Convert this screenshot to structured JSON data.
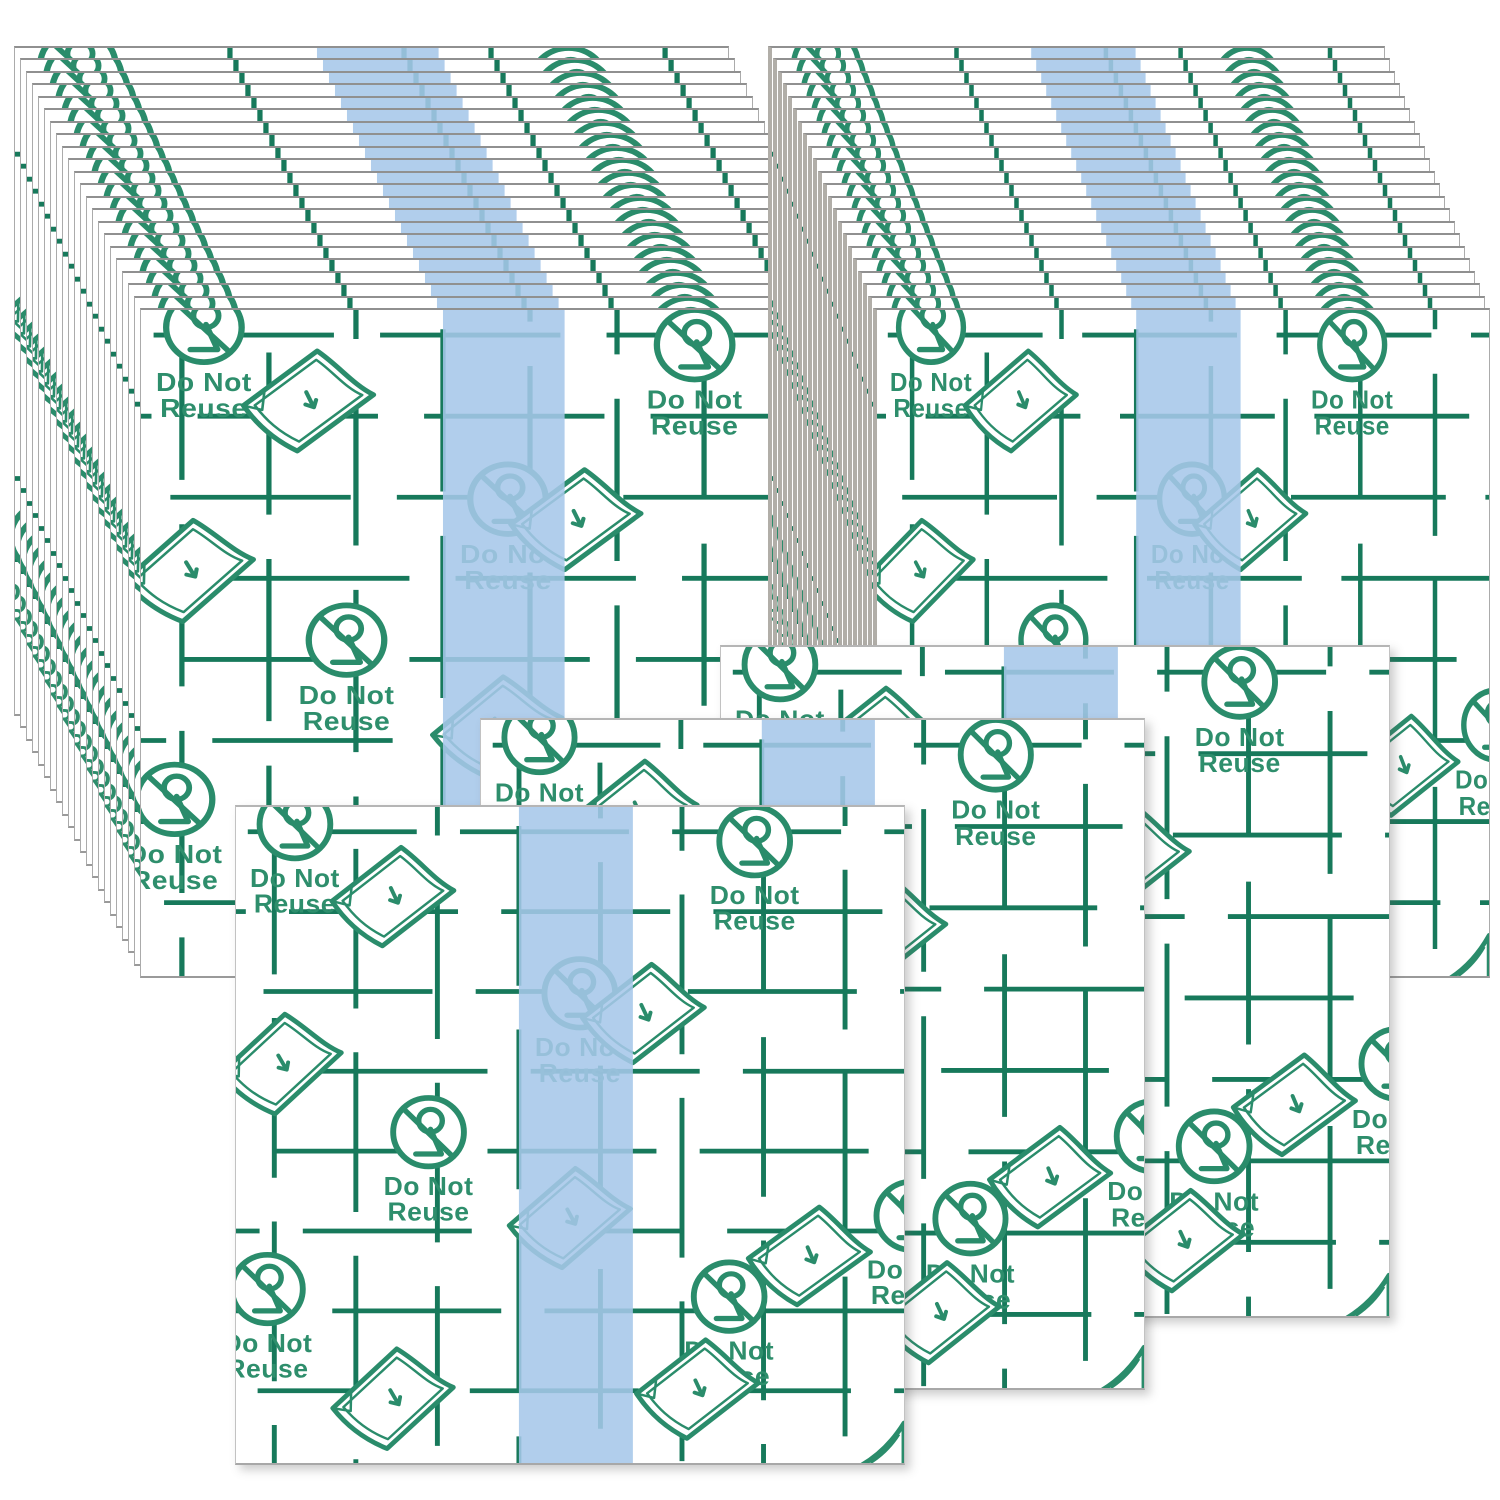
{
  "product": {
    "print_label_line1": "Do Not",
    "print_label_line2": "Reuse"
  },
  "scene": {
    "description": "Product photo of transparent adhesive transfer film sheets",
    "stack_count": 2,
    "loose_sheet_count": 3,
    "sheets_visible_per_stack": 22,
    "background": "#ffffff"
  },
  "colors": {
    "grid_green": "#17795b",
    "icon_green": "#2a8c6b",
    "label_green": "#2e8e6c",
    "stripe_blue": "#a6c7e9",
    "edge_gray": "#ababab"
  },
  "icons": {
    "do_not_reuse_icon": "circled-2-with-slash",
    "folded_corner_icon": "peeling-film-corner",
    "corner_mark_icon": "curled-sheet-corner"
  }
}
